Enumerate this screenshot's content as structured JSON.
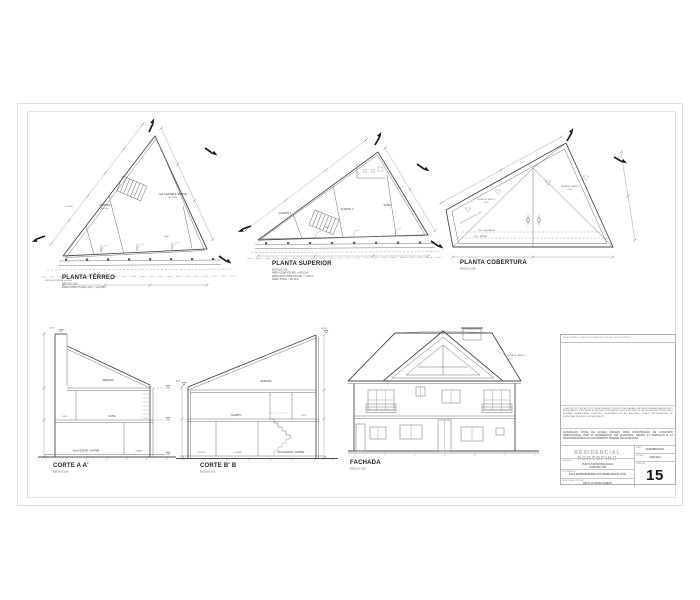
{
  "planta_terreo": {
    "title": "PLANTA TÉRREO",
    "sub1": "ESCALA 1:50",
    "sub2": "ÁREA COMPUTÁVEL (P.B.) = 111,08m²",
    "muro_note": "MURO ALV. PREDIAL H=1,80m",
    "rooms": {
      "aserv": "A. SERV.",
      "cozinha": "COZINHA",
      "cozinha_area": "A=8,50m²",
      "sala": "SALA ESTAR E JANTAR",
      "sala_area": "A=27,80m²",
      "hall": "HALL"
    }
  },
  "planta_superior": {
    "title": "PLANTA SUPERIOR",
    "sub1": "ESCALA 1:50",
    "sub2": "ÁREA COMPUTÁVEL = 98,12m²",
    "sub3": "ÁREA NÃO COMPUTÁVEL = 1,20m²",
    "sub4": "ÁREA TOTAL = 99,32m²",
    "rooms": {
      "quarto1": "QUARTO 1",
      "quarto2": "QUARTO 2",
      "suite": "SUÍTE",
      "bwc": "BWC"
    }
  },
  "planta_cobertura": {
    "title": "PLANTA COBERTURA",
    "sub1": "ESCALA 1:50",
    "telha_l1": "TELHA DE CIMENTO",
    "telha_l2": "i=35%",
    "telha_r1": "TELHA DE CIMENTO",
    "telha_r2": "i=35%",
    "telha_edge": "TELHA DE CIMENTO i=35%",
    "alvenaria": "PROJ. ALVENARIA",
    "beiral": "PROJ. BEIRAL"
  },
  "corte_a": {
    "title": "CORTE A A'",
    "sub1": "ESCALA 1:50",
    "level_top": "10,70",
    "rooms": {
      "servico": "SERVIÇO",
      "bwc": "BWC",
      "suite": "SUÍTE",
      "sala": "SALA ESTAR / JANTAR",
      "lavabo": "LAVABO"
    }
  },
  "corte_b": {
    "title": "CORTE B' B",
    "sub1": "ESCALA 1:50",
    "level_top": "10,70",
    "level_left": "8,45",
    "rooms": {
      "servico": "SERVIÇO",
      "quarto": "QUARTO",
      "bwc": "BWC",
      "aserv": "A. SERV.",
      "cozinha": "COZINHA",
      "sala": "SALA ESTAR / JANTAR"
    }
  },
  "fachada": {
    "title": "FACHADA",
    "sub1": "ESCALA 1:50",
    "note1": "TELHA DE CIMENTO",
    "note2": "i=35%"
  },
  "title_block": {
    "top_note": "ESTE DESENHO É PARTE INTEGRANTE DO PROJETO ARQUITETÔNICO",
    "disclaimer": "O AUTOR DO PROJETO E O RESPONSÁVEL TÉCNICO DECLARAM QUE RESPONSABILIZAM-SE PELO ATENDIMENTO DAS ESPECIFICAÇÕES CONSTANTES DESTE PROJETO E DA LEGISLAÇÃO MUNICIPAL E NORMAS BRASILEIRAS VIGENTES, SUJEITANDO-SE ÀS SANÇÕES LEGAIS DECORRENTES DE EVENTUAIS PREJUÍZOS A TERCEIROS.",
    "description": "ALTERAÇÃO TOTAL DE ALVARÁ 345/2021 PARA CONSTRUÇÃO DE CONJUNTO HABITACIONAL COM 08 RESIDÊNCIAS EM ALVENARIA, SENDO 47 PARCELAS E 21 TRANSGRESSÕES AO ALINHAMENTO PREDIAL DE ALVENARIA.",
    "project": "RESIDENCIAL PORTOFINO",
    "address_label": "ENDEREÇO",
    "address1": "PUNTA CORSO BOLOGNA",
    "address2": "CURITIBA / PR",
    "owner_label": "PROPRIETÁRIO",
    "owner": "SCLA EMPREENDIMENTOS IMOBILIÁRIOS LTDA",
    "resp_label": "RESPONSÁVEL TÉCNICO",
    "resp": "ARQT. ANTONIO GRECH",
    "data_label": "DATA",
    "data_value": "DEZEMBRO/2021",
    "escala_label": "ESCALA",
    "escala_value": "INDICADA",
    "prancha_label": "PRANCHA",
    "prancha": "15"
  }
}
